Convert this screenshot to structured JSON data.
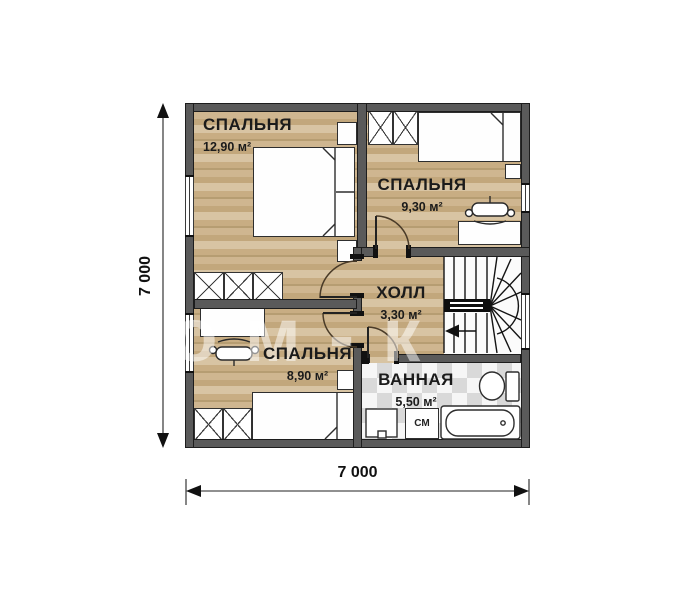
{
  "watermark": "дом-к",
  "dimensions": {
    "horizontal": "7 000",
    "vertical": "7 000"
  },
  "rooms": {
    "bedroom_large": {
      "name": "СПАЛЬНЯ",
      "area": "12,90 м²"
    },
    "bedroom_right": {
      "name": "СПАЛЬНЯ",
      "area": "9,30 м²"
    },
    "hall": {
      "name": "ХОЛЛ",
      "area": "3,30 м²"
    },
    "bedroom_small": {
      "name": "СПАЛЬНЯ",
      "area": "8,90 м²"
    },
    "bathroom": {
      "name": "ВАННАЯ",
      "area": "5,50 м²"
    }
  },
  "appliances": {
    "washing_machine": "СМ"
  },
  "colors": {
    "wall": "#5a5a5a",
    "wood": "#c9ae85",
    "tile": "#d9d9d9",
    "line": "#1c1c1c"
  }
}
